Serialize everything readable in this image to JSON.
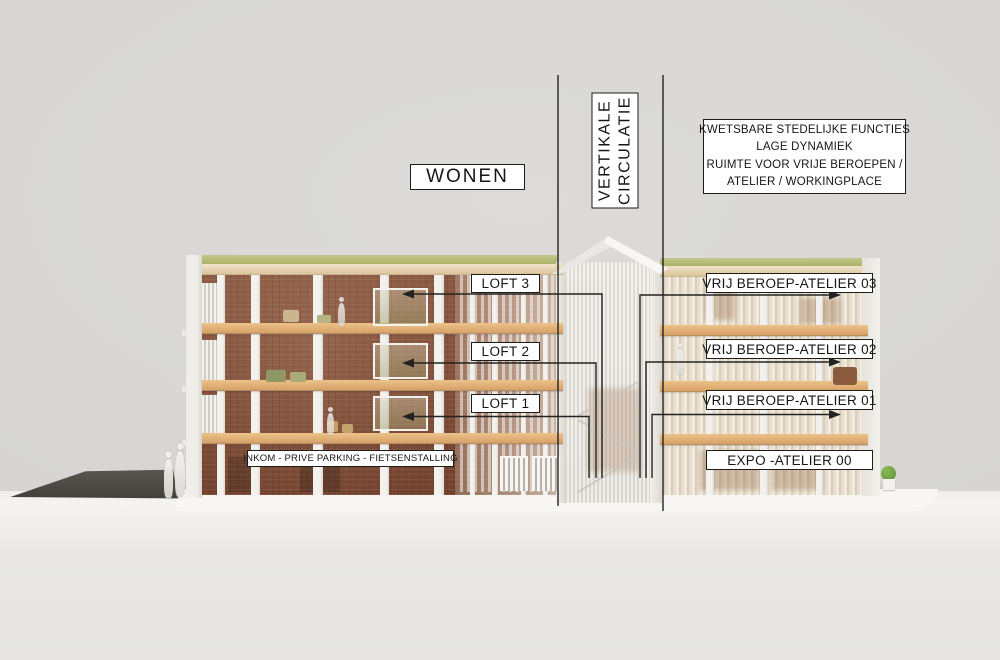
{
  "slide": {
    "type": "architectural-section-model-diagram",
    "annotations": {
      "wonen": {
        "label": "WONEN"
      },
      "vertikale": {
        "line1": "VERTIKALE",
        "line2": "CIRCULATIE"
      },
      "kwetsbare": {
        "lines": [
          "KWETSBARE STEDELIJKE FUNCTIES",
          "LAGE DYNAMIEK",
          "RUIMTE VOOR VRIJE BEROEPEN /",
          "ATELIER / WORKINGPLACE"
        ]
      },
      "left_floors": [
        {
          "label": "LOFT 3"
        },
        {
          "label": "LOFT 2"
        },
        {
          "label": "LOFT 1"
        }
      ],
      "right_floors": [
        {
          "label": "VRIJ BEROEP-ATELIER 03"
        },
        {
          "label": "VRIJ BEROEP-ATELIER 02"
        },
        {
          "label": "VRIJ BEROEP-ATELIER 01"
        },
        {
          "label": "EXPO -ATELIER 00"
        }
      ],
      "ground_label": "INKOM - PRIVE PARKING - FIETSENSTALLING"
    }
  },
  "colors": {
    "background": "#d7d6d4",
    "table": "#e6e5e3",
    "brick": "#7d4b36",
    "wood_slab": "#d6a168",
    "roof_green": "#a8b164",
    "model_white": "#f3f1ee",
    "ramp_dark": "#4e4c48",
    "line_color": "#232321",
    "label_bg": "#ffffff",
    "label_border": "#1c1c1a"
  }
}
